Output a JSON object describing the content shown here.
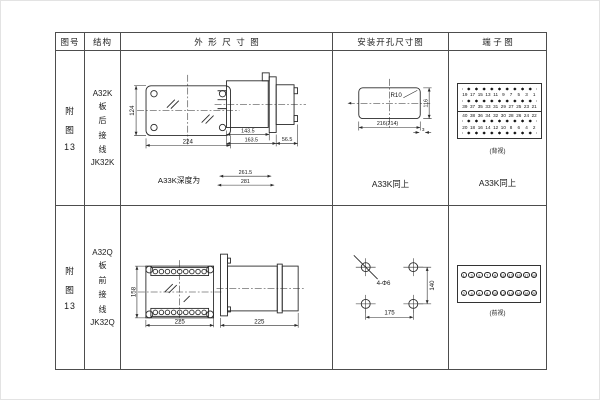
{
  "page": {
    "bg": "#ffffff",
    "grid_line": "#4d4d4d",
    "ink": "#1a1a1a"
  },
  "headers": {
    "fig_no": "图号",
    "structure": "结构",
    "outline": "外形尺寸图",
    "install": "安装开孔尺寸图",
    "terminal": "端子图"
  },
  "row1": {
    "fig_lines": [
      "附",
      "图",
      "13"
    ],
    "structure_lines": [
      "A32K",
      "板",
      "后",
      "接",
      "线",
      "JK32K"
    ],
    "outline": {
      "height": "124",
      "width": "224",
      "case_depth": "143.5",
      "flange_depth": "163.5",
      "rear_depth": "56.5",
      "depth_note": "A33K深度为",
      "depth1": "261.5",
      "depth2": "281"
    },
    "install": {
      "radius": "R10",
      "width": "216(214)",
      "height": "116",
      "gap": "3",
      "note": "A33K同上"
    },
    "terminal": {
      "number_rows": [
        [
          "19",
          "17",
          "15",
          "13",
          "11",
          "9",
          "7",
          "5",
          "3",
          "1"
        ],
        [
          "39",
          "37",
          "35",
          "33",
          "31",
          "29",
          "27",
          "25",
          "23",
          "21"
        ],
        [
          "40",
          "38",
          "36",
          "34",
          "32",
          "30",
          "28",
          "26",
          "24",
          "22"
        ],
        [
          "20",
          "18",
          "16",
          "14",
          "12",
          "10",
          "8",
          "6",
          "4",
          "2"
        ]
      ],
      "caption": "(背视)",
      "note": "A33K同上"
    }
  },
  "row2": {
    "fig_lines": [
      "附",
      "图",
      "13"
    ],
    "structure_lines": [
      "A32Q",
      "板",
      "前",
      "接",
      "线",
      "JK32Q"
    ],
    "outline": {
      "height": "158",
      "width": "225",
      "depth": "225"
    },
    "install": {
      "holes": "4-Φ6",
      "width": "175",
      "height": "140"
    },
    "terminal": {
      "rows": [
        [
          "1",
          "3",
          "5",
          "7",
          "9",
          "11",
          "13",
          "15",
          "17",
          "19"
        ],
        [
          "2",
          "4",
          "6",
          "8",
          "10",
          "12",
          "14",
          "16",
          "18",
          "20"
        ]
      ],
      "caption": "(前视)"
    }
  }
}
